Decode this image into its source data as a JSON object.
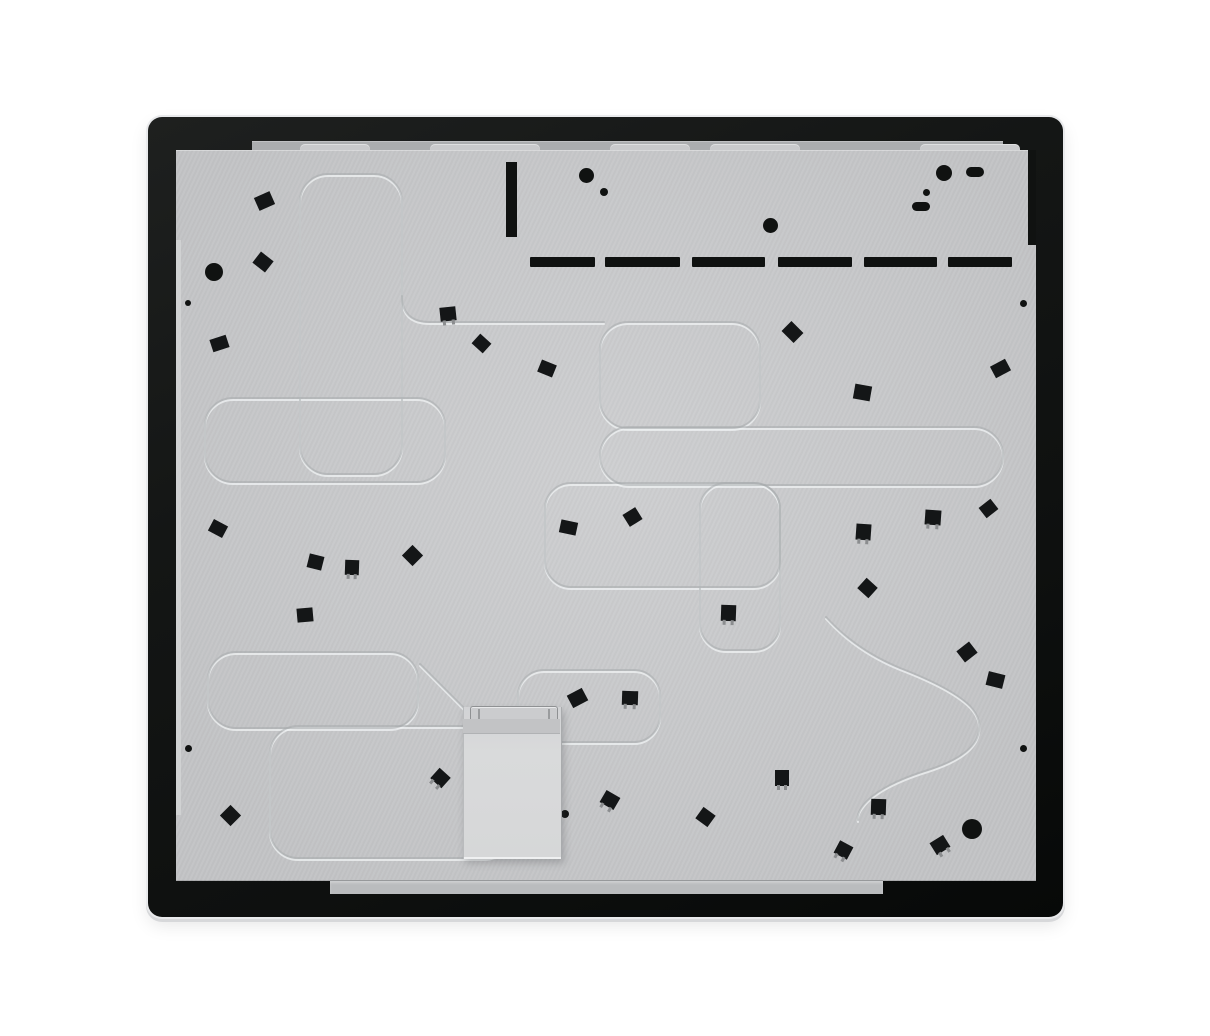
{
  "scene": {
    "subject": "appliance-back-panel-photo",
    "colors": {
      "background": "#ffffff",
      "glass_black": "#101211",
      "panel_gray": "#c9cacc",
      "flange_gray": "#abadaf",
      "box_gray": "#d7d8d9",
      "clip_black": "#141617",
      "groove_dark": "#a8abad",
      "groove_light": "#eef0f1"
    }
  },
  "frame": {
    "x": 148,
    "y": 117,
    "w": 915,
    "h": 800
  },
  "panel": {
    "x": 176,
    "y": 150,
    "w": 860,
    "h": 731
  },
  "top_flange": {
    "x": 252,
    "y": 141,
    "w": 751,
    "h": 10
  },
  "bottom_flange": {
    "x": 330,
    "y": 880,
    "w": 553,
    "h": 13
  },
  "left_flange": {
    "x": 176,
    "y": 240,
    "w": 5,
    "h": 575
  },
  "panel_step": {
    "x": 1028,
    "y": 150,
    "w": 8,
    "h": 95
  },
  "panel_tabs": {
    "y": 144,
    "h": 8,
    "segments": [
      [
        300,
        70
      ],
      [
        430,
        110
      ],
      [
        610,
        80
      ],
      [
        710,
        90
      ],
      [
        920,
        100
      ]
    ]
  },
  "vent_bar": {
    "x": 506,
    "y": 162,
    "w": 11,
    "h": 75
  },
  "vent_dashes": {
    "y": 257,
    "h": 10,
    "segments": [
      [
        530,
        65
      ],
      [
        605,
        75
      ],
      [
        692,
        73
      ],
      [
        778,
        74
      ],
      [
        864,
        73
      ],
      [
        948,
        64
      ]
    ]
  },
  "slot_pills": [
    {
      "x": 966,
      "y": 167,
      "w": 18,
      "h": 10
    },
    {
      "x": 912,
      "y": 202,
      "w": 18,
      "h": 9
    }
  ],
  "dots": [
    {
      "x": 214,
      "y": 272,
      "d": 18
    },
    {
      "x": 188,
      "y": 303,
      "d": 6
    },
    {
      "x": 586,
      "y": 175,
      "d": 15
    },
    {
      "x": 604,
      "y": 192,
      "d": 8
    },
    {
      "x": 770,
      "y": 225,
      "d": 15
    },
    {
      "x": 944,
      "y": 173,
      "d": 16
    },
    {
      "x": 926,
      "y": 192,
      "d": 7
    },
    {
      "x": 1023,
      "y": 303,
      "d": 7
    },
    {
      "x": 188,
      "y": 748,
      "d": 7
    },
    {
      "x": 1023,
      "y": 748,
      "d": 7
    },
    {
      "x": 565,
      "y": 814,
      "d": 8
    },
    {
      "x": 972,
      "y": 829,
      "d": 20
    }
  ],
  "clips": [
    {
      "x": 264,
      "y": 201,
      "w": 17,
      "h": 14,
      "rot": -24,
      "legs": 0
    },
    {
      "x": 263,
      "y": 262,
      "w": 16,
      "h": 14,
      "rot": 38,
      "legs": 0
    },
    {
      "x": 219,
      "y": 343,
      "w": 17,
      "h": 13,
      "rot": -18,
      "legs": 0
    },
    {
      "x": 448,
      "y": 314,
      "w": 16,
      "h": 14,
      "rot": -6,
      "legs": 1
    },
    {
      "x": 481,
      "y": 343,
      "w": 15,
      "h": 13,
      "rot": 42,
      "legs": 0
    },
    {
      "x": 547,
      "y": 368,
      "w": 16,
      "h": 13,
      "rot": 22,
      "legs": 0
    },
    {
      "x": 792,
      "y": 332,
      "w": 17,
      "h": 14,
      "rot": 45,
      "legs": 0
    },
    {
      "x": 862,
      "y": 392,
      "w": 17,
      "h": 15,
      "rot": 10,
      "legs": 0
    },
    {
      "x": 1000,
      "y": 368,
      "w": 17,
      "h": 13,
      "rot": -28,
      "legs": 0
    },
    {
      "x": 218,
      "y": 528,
      "w": 16,
      "h": 13,
      "rot": 28,
      "legs": 0
    },
    {
      "x": 315,
      "y": 562,
      "w": 15,
      "h": 14,
      "rot": 14,
      "legs": 0
    },
    {
      "x": 352,
      "y": 567,
      "w": 14,
      "h": 15,
      "rot": 2,
      "legs": 1
    },
    {
      "x": 412,
      "y": 555,
      "w": 15,
      "h": 15,
      "rot": 45,
      "legs": 0
    },
    {
      "x": 568,
      "y": 527,
      "w": 17,
      "h": 13,
      "rot": 12,
      "legs": 0
    },
    {
      "x": 632,
      "y": 517,
      "w": 15,
      "h": 14,
      "rot": -32,
      "legs": 0
    },
    {
      "x": 933,
      "y": 517,
      "w": 16,
      "h": 15,
      "rot": 4,
      "legs": 1
    },
    {
      "x": 988,
      "y": 508,
      "w": 15,
      "h": 13,
      "rot": -38,
      "legs": 0
    },
    {
      "x": 863,
      "y": 532,
      "w": 15,
      "h": 16,
      "rot": 4,
      "legs": 1
    },
    {
      "x": 867,
      "y": 588,
      "w": 15,
      "h": 14,
      "rot": 42,
      "legs": 0
    },
    {
      "x": 305,
      "y": 615,
      "w": 16,
      "h": 14,
      "rot": -5,
      "legs": 0
    },
    {
      "x": 577,
      "y": 698,
      "w": 17,
      "h": 14,
      "rot": -28,
      "legs": 0
    },
    {
      "x": 630,
      "y": 698,
      "w": 16,
      "h": 14,
      "rot": 2,
      "legs": 1
    },
    {
      "x": 728,
      "y": 613,
      "w": 15,
      "h": 16,
      "rot": 2,
      "legs": 1
    },
    {
      "x": 967,
      "y": 652,
      "w": 16,
      "h": 14,
      "rot": -38,
      "legs": 0
    },
    {
      "x": 995,
      "y": 680,
      "w": 17,
      "h": 14,
      "rot": 14,
      "legs": 0
    },
    {
      "x": 230,
      "y": 815,
      "w": 15,
      "h": 15,
      "rot": 45,
      "legs": 0
    },
    {
      "x": 440,
      "y": 778,
      "w": 15,
      "h": 14,
      "rot": 42,
      "legs": 1
    },
    {
      "x": 610,
      "y": 800,
      "w": 16,
      "h": 14,
      "rot": 30,
      "legs": 1
    },
    {
      "x": 705,
      "y": 817,
      "w": 15,
      "h": 14,
      "rot": 36,
      "legs": 0
    },
    {
      "x": 782,
      "y": 778,
      "w": 14,
      "h": 16,
      "rot": 0,
      "legs": 1
    },
    {
      "x": 843,
      "y": 850,
      "w": 15,
      "h": 14,
      "rot": 28,
      "legs": 1
    },
    {
      "x": 878,
      "y": 807,
      "w": 15,
      "h": 16,
      "rot": 2,
      "legs": 1
    },
    {
      "x": 940,
      "y": 845,
      "w": 16,
      "h": 14,
      "rot": -32,
      "legs": 1
    }
  ],
  "junction_box": {
    "x": 463,
    "y": 707,
    "w": 97,
    "h": 152
  },
  "junction_lip": {
    "x": 470,
    "y": 706,
    "w": 86,
    "h": 13
  },
  "junction_band": {
    "x": 463,
    "y": 719,
    "w": 97,
    "h": 14
  },
  "grooves": {
    "rects": [
      {
        "x": 300,
        "y": 174,
        "w": 102,
        "h": 300,
        "r": 28
      },
      {
        "x": 205,
        "y": 398,
        "w": 240,
        "h": 84,
        "r": 28
      },
      {
        "x": 545,
        "y": 483,
        "w": 235,
        "h": 104,
        "r": 26
      },
      {
        "x": 700,
        "y": 483,
        "w": 80,
        "h": 167,
        "r": 26
      },
      {
        "x": 600,
        "y": 322,
        "w": 160,
        "h": 106,
        "r": 28
      },
      {
        "x": 600,
        "y": 427,
        "w": 403,
        "h": 58,
        "r": 29
      },
      {
        "x": 208,
        "y": 652,
        "w": 210,
        "h": 76,
        "r": 28
      },
      {
        "x": 270,
        "y": 726,
        "w": 242,
        "h": 132,
        "r": 28
      },
      {
        "x": 518,
        "y": 670,
        "w": 142,
        "h": 72,
        "r": 26
      }
    ],
    "paths": [
      "M 420,664 L 504,748",
      "M 402,296 Q 402,322 430,322 L 604,322",
      "M 826,617 Q 856,650 900,668 Q 952,688 970,706 Q 985,722 976,740 Q 966,758 928,770 Q 886,783 868,800 Q 856,812 858,820"
    ]
  }
}
